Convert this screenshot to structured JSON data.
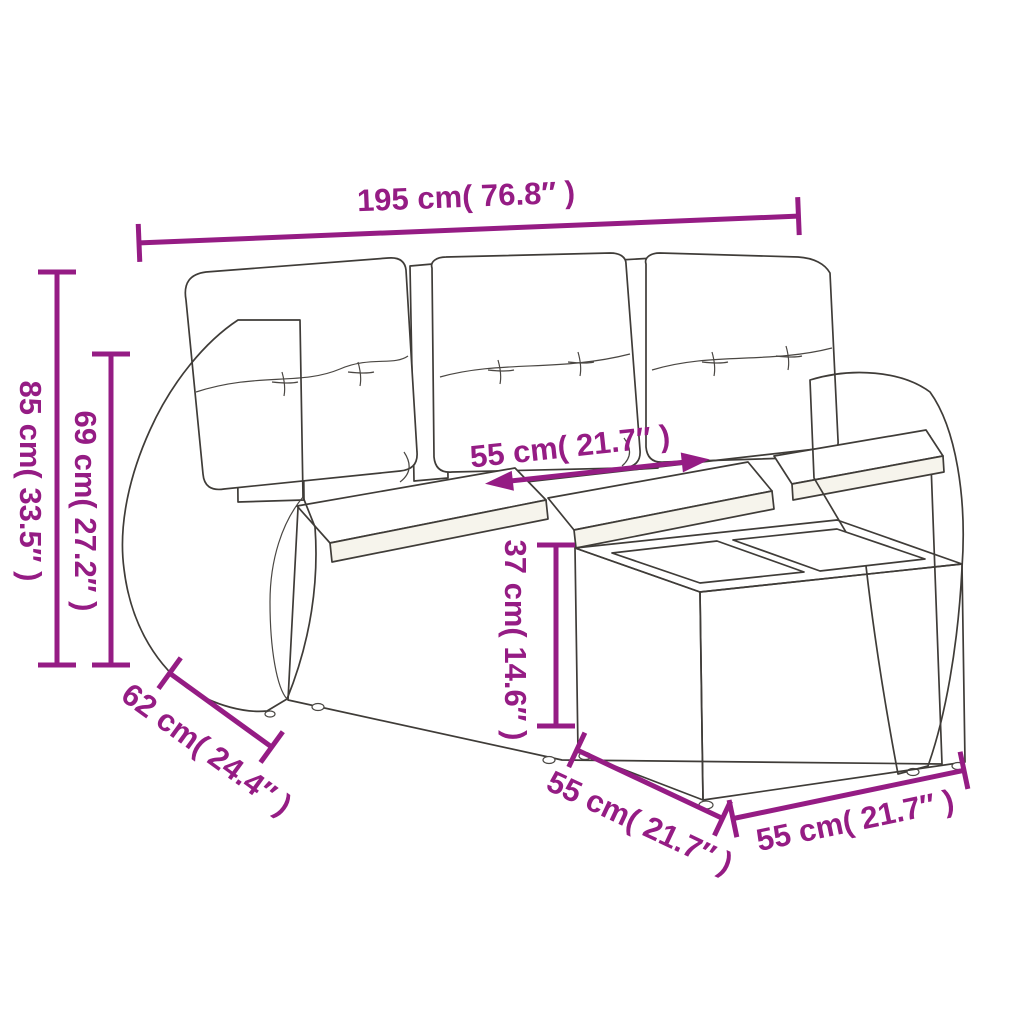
{
  "accent_color": "#951c84",
  "ink_color": "#3f3c38",
  "figure": {
    "subject": "rattan-garden-sofa-set-with-cushions-and-glass-top-table"
  },
  "labels": {
    "overall_width": "195 cm( 76.8″ )",
    "overall_height": "85 cm( 33.5″ )",
    "back_height": "69 cm( 27.2″ )",
    "armrest_depth": "62 cm( 24.4″ )",
    "seat_width": "55 cm( 21.7″ )",
    "table_height": "37 cm( 14.6″ )",
    "table_depth": "55 cm( 21.7″ )",
    "table_width": "55 cm( 21.7″ )"
  }
}
